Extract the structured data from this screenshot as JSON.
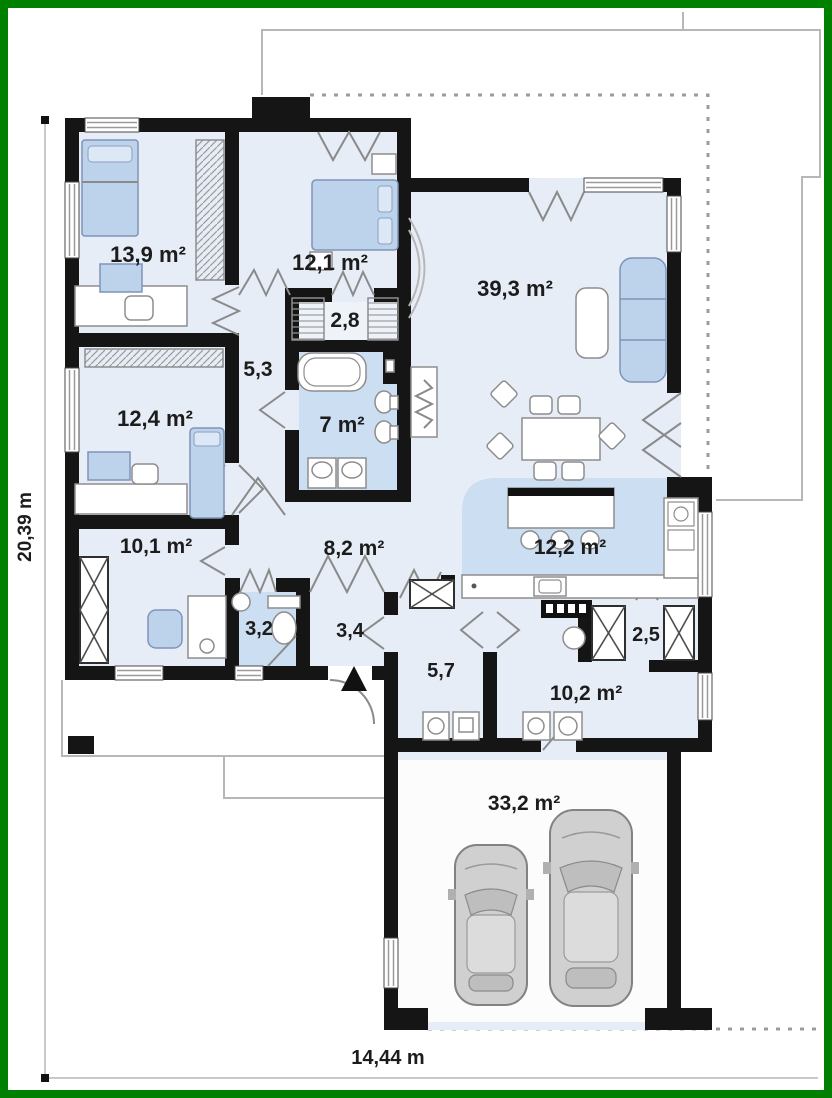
{
  "colors": {
    "frame_green": "#008000",
    "wall": "#151515",
    "room_fill": "#e7edf7",
    "wet_room_fill": "#ccdef2",
    "furniture_blue": "#bdd3ec",
    "outline_gray": "#b7b7b7",
    "dash_gray": "#9c9c9c",
    "label": "#1c1c1c"
  },
  "dimensions": {
    "height_label": "20,39 m",
    "width_label": "14,44 m"
  },
  "rooms": {
    "bedroom1": {
      "label": "13,9 m²"
    },
    "bedroom2": {
      "label": "12,1 m²"
    },
    "closet": {
      "label": "2,8"
    },
    "hall_bedrooms": {
      "label": "5,3"
    },
    "living": {
      "label": "39,3 m²"
    },
    "bedroom3": {
      "label": "12,4 m²"
    },
    "bathroom": {
      "label": "7 m²"
    },
    "bedroom4": {
      "label": "10,1 m²"
    },
    "corridor": {
      "label": "8,2 m²"
    },
    "kitchen": {
      "label": "12,2 m²"
    },
    "wc": {
      "label": "3,2"
    },
    "vestibule": {
      "label": "3,4"
    },
    "pantry": {
      "label": "2,5"
    },
    "hall_entry": {
      "label": "5,7"
    },
    "utility": {
      "label": "10,2 m²"
    },
    "garage": {
      "label": "33,2 m²"
    }
  }
}
